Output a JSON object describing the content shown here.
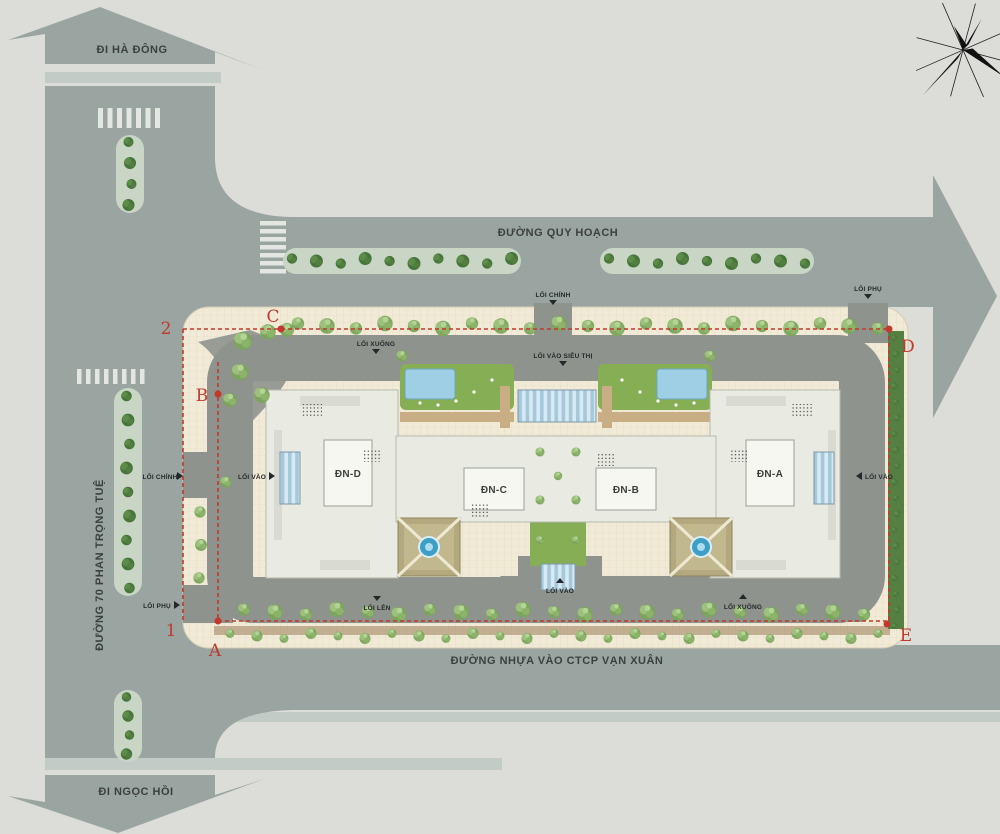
{
  "plan": {
    "roads": {
      "quy_hoach": "ĐƯỜNG QUY HOẠCH",
      "phan_trong_tue": "ĐƯỜNG 70 PHAN TRỌNG TUỆ",
      "nhua_van_xuan": "ĐƯỜNG NHỰA VÀO CTCP VẠN XUÂN"
    },
    "directions": {
      "ha_dong": "ĐI HÀ ĐÔNG",
      "ngoc_hoi": "ĐI NGỌC HỒI"
    },
    "buildings": {
      "dn_a": "ĐN-A",
      "dn_b": "ĐN-B",
      "dn_c": "ĐN-C",
      "dn_d": "ĐN-D"
    },
    "entrances": {
      "main_top": "LỐI CHÍNH",
      "secondary_top": "LỐI PHỤ",
      "ramp_down_top": "LỐI XUỐNG",
      "supermarket": "LỐI VÀO SIÊU THỊ",
      "main_left": "LỐI CHÍNH",
      "entry_left": "LỐI VÀO",
      "secondary_left": "LỐI PHỤ",
      "ramp_up_bottom": "LỐI LÊN",
      "entry_bottom": "LỐI VÀO",
      "ramp_down_bottom": "LỐI XUỐNG",
      "entry_right": "LỐI VÀO"
    },
    "markers": {
      "m1": "1",
      "m2": "2",
      "ma": "A",
      "mb": "B",
      "mc": "C",
      "md": "D",
      "me": "E"
    },
    "colors": {
      "background": "#dcdcd8",
      "road": "#9aa5a1",
      "road_light": "#c3cbc6",
      "tile": "#f1ead7",
      "driveway": "#8e938e",
      "podium": "#e9eae2",
      "building": "#f7f7f2",
      "lawn": "#85ae55",
      "pool": "#9ecfe5",
      "deck_tan": "#c8ad85",
      "boundary_red": "#c0392b",
      "label_dark": "#3c403d"
    }
  }
}
